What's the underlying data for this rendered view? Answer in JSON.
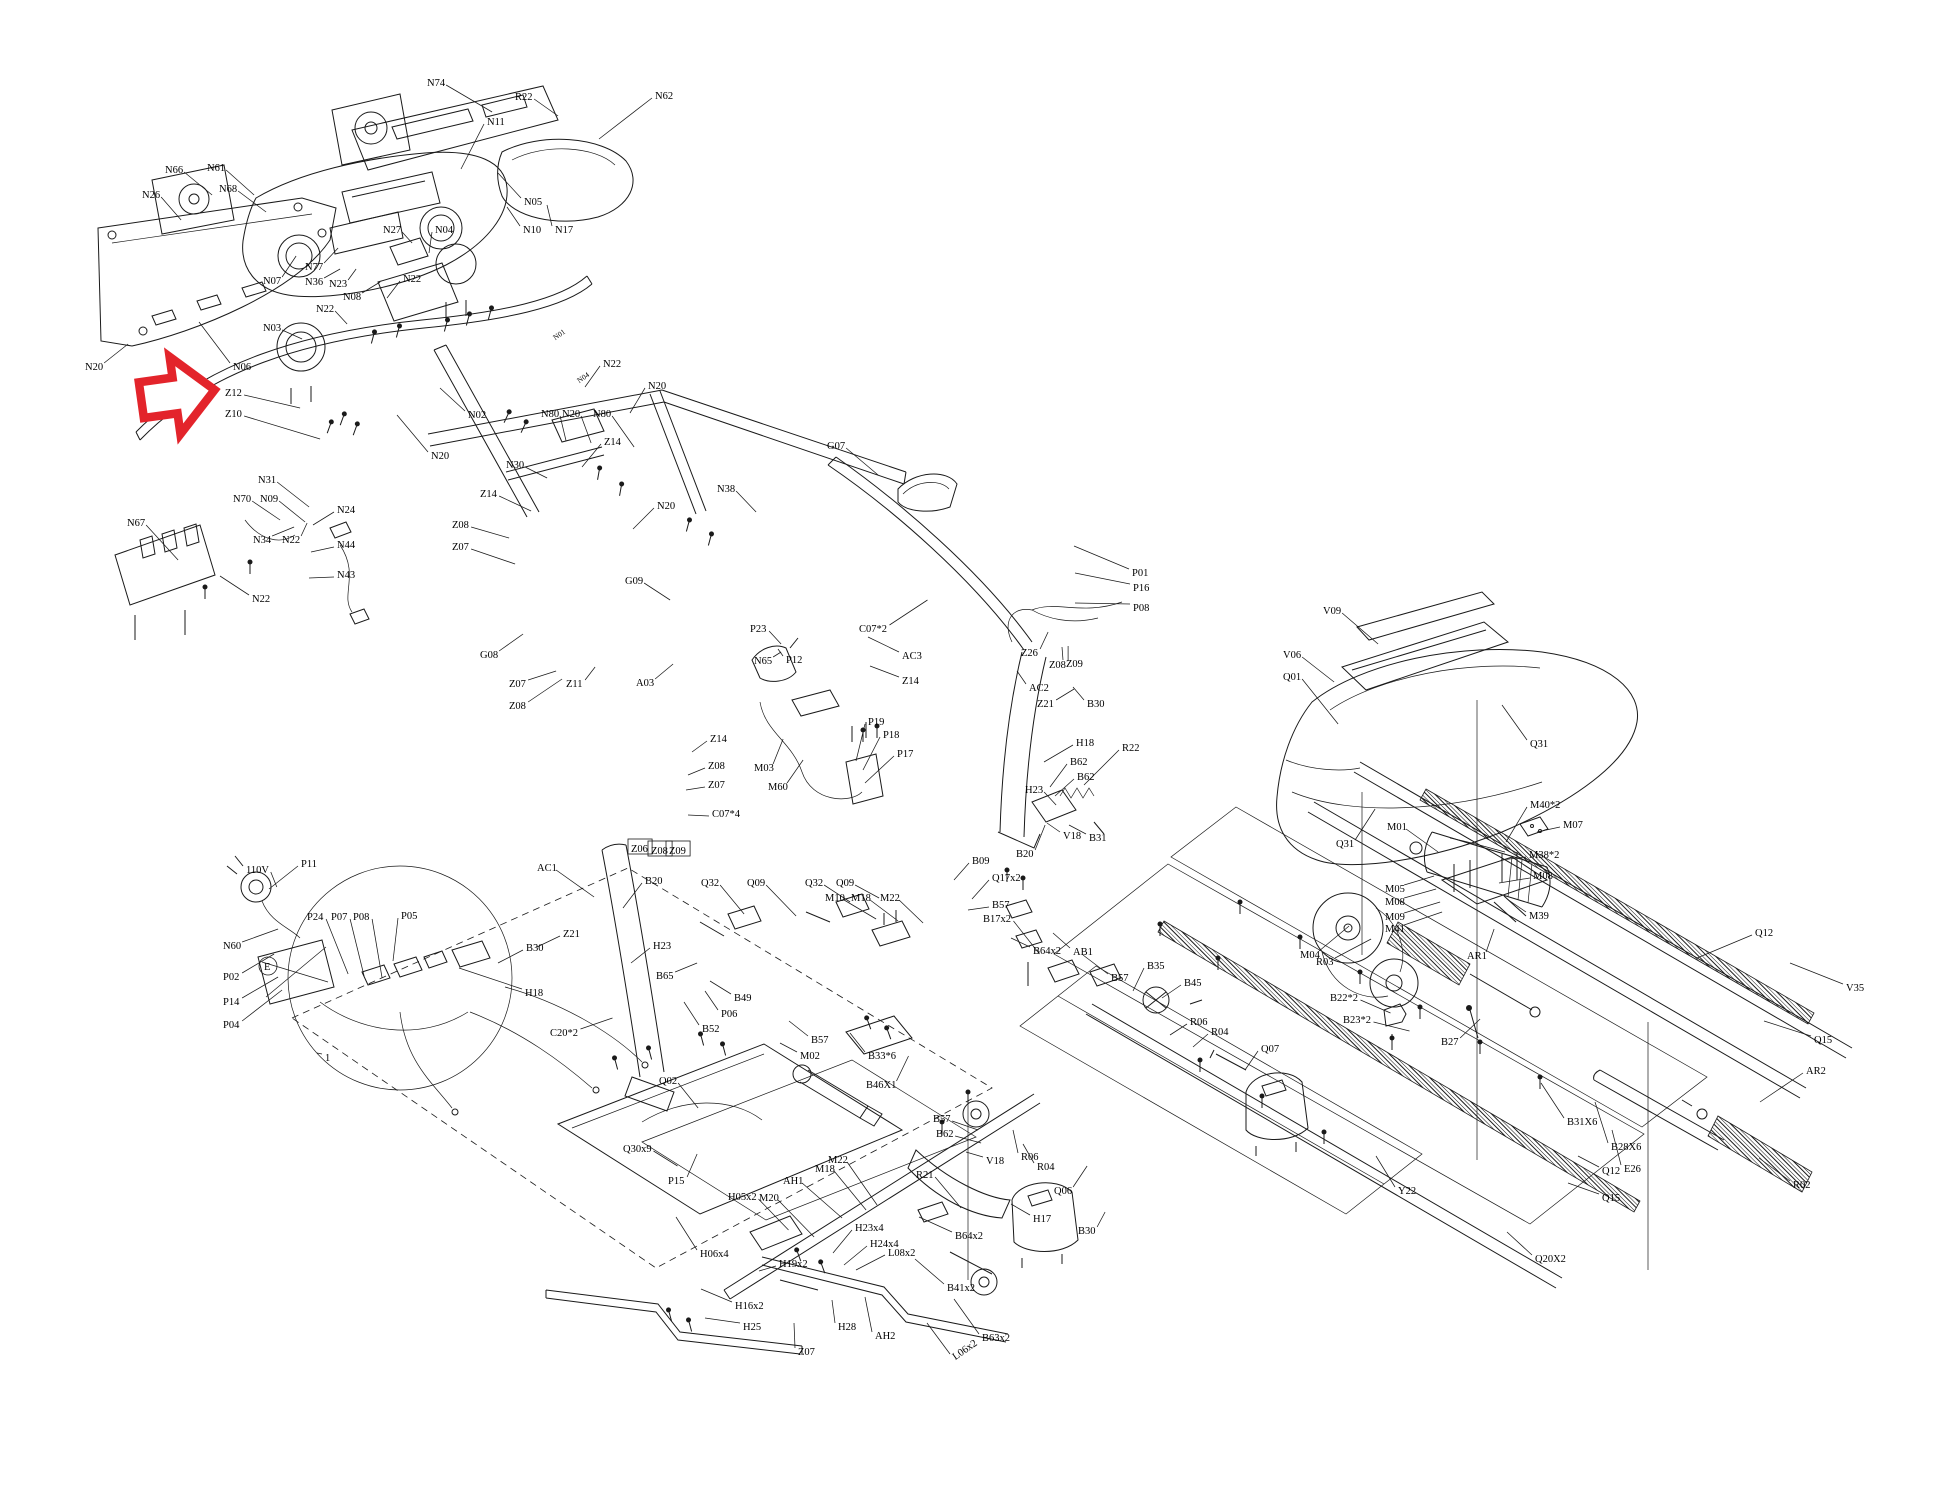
{
  "diagram": {
    "type": "exploded-parts-diagram",
    "subject": "treadmill assembly",
    "background": "#ffffff",
    "line_color": "#1a1a1a"
  },
  "arrow": {
    "color": "#e3242b",
    "points": "141,377 175,377 175,356 215,395 175,434 175,413 141,413",
    "rotation": -8,
    "cx": 178,
    "cy": 395,
    "target_label": "Z12"
  },
  "labels": [
    [
      "N74",
      427,
      82,
      48,
      30,
      null
    ],
    [
      "R22",
      515,
      96,
      26,
      20,
      null
    ],
    [
      "N11",
      487,
      121,
      -26,
      48,
      null
    ],
    [
      "N62",
      655,
      95,
      -56,
      44,
      null
    ],
    [
      "N05",
      524,
      201,
      -26,
      -28,
      null
    ],
    [
      "N10",
      523,
      229,
      -16,
      -22,
      null
    ],
    [
      "N17",
      555,
      229,
      -8,
      -24,
      null
    ],
    [
      "N66",
      165,
      169,
      30,
      26,
      null
    ],
    [
      "N61",
      207,
      167,
      30,
      28,
      null
    ],
    [
      "N26",
      142,
      194,
      22,
      26,
      null
    ],
    [
      "N68",
      219,
      188,
      30,
      24,
      null
    ],
    [
      "N27",
      383,
      229,
      12,
      14,
      null
    ],
    [
      "N04",
      435,
      229,
      -6,
      24,
      null
    ],
    [
      "N07",
      263,
      280,
      16,
      -24,
      null
    ],
    [
      "N77",
      305,
      266,
      16,
      -18,
      null
    ],
    [
      "N36",
      305,
      281,
      18,
      -12,
      null
    ],
    [
      "N23",
      329,
      283,
      10,
      -14,
      null
    ],
    [
      "N08",
      343,
      296,
      20,
      -14,
      null
    ],
    [
      "N22",
      403,
      278,
      -16,
      20,
      null
    ],
    [
      "N22",
      316,
      308,
      14,
      16,
      null
    ],
    [
      "N03",
      263,
      327,
      22,
      12,
      null
    ],
    [
      "N06",
      233,
      366,
      -34,
      -44,
      null
    ],
    [
      "N20",
      85,
      366,
      26,
      -22,
      null
    ],
    [
      "Z12",
      225,
      392,
      58,
      16,
      null
    ],
    [
      "Z10",
      225,
      413,
      78,
      26,
      null
    ],
    [
      "N01",
      553,
      337,
      null,
      null,
      "t"
    ],
    [
      "N04",
      577,
      380,
      null,
      null,
      "t"
    ],
    [
      "N22",
      603,
      363,
      -18,
      24,
      null
    ],
    [
      "N02",
      468,
      414,
      -28,
      -26,
      null
    ],
    [
      "N20",
      431,
      455,
      -34,
      -40,
      null
    ],
    [
      "N20",
      648,
      385,
      -18,
      28,
      null
    ],
    [
      "N80",
      541,
      413,
      8,
      28,
      null
    ],
    [
      "N20",
      562,
      413,
      12,
      30,
      null
    ],
    [
      "N80",
      593,
      413,
      24,
      34,
      null
    ],
    [
      "Z14",
      604,
      441,
      -22,
      26,
      null
    ],
    [
      "N30",
      506,
      464,
      24,
      14,
      null
    ],
    [
      "Z14",
      480,
      493,
      34,
      18,
      null
    ],
    [
      "Z08",
      452,
      524,
      40,
      14,
      null
    ],
    [
      "Z07",
      452,
      546,
      46,
      18,
      null
    ],
    [
      "N20",
      657,
      505,
      -24,
      24,
      null
    ],
    [
      "N31",
      258,
      479,
      34,
      28,
      null
    ],
    [
      "N70",
      233,
      498,
      30,
      22,
      null
    ],
    [
      "N09",
      260,
      498,
      28,
      24,
      null
    ],
    [
      "N67",
      127,
      522,
      34,
      38,
      null
    ],
    [
      "N34",
      253,
      539,
      24,
      -12,
      null
    ],
    [
      "N22",
      282,
      539,
      8,
      -16,
      null
    ],
    [
      "N24",
      337,
      509,
      -24,
      16,
      null
    ],
    [
      "N44",
      337,
      544,
      -26,
      8,
      null
    ],
    [
      "N43",
      337,
      574,
      -28,
      4,
      null
    ],
    [
      "N22",
      252,
      598,
      -32,
      -22,
      null
    ],
    [
      "G08",
      480,
      654,
      26,
      -20,
      null
    ],
    [
      "Z07",
      509,
      683,
      30,
      -12,
      null
    ],
    [
      "Z11",
      566,
      683,
      12,
      -16,
      null
    ],
    [
      "A03",
      636,
      682,
      20,
      -18,
      null
    ],
    [
      "Z08",
      509,
      705,
      36,
      -26,
      null
    ],
    [
      "G09",
      625,
      580,
      28,
      20,
      null
    ],
    [
      "N38",
      717,
      488,
      22,
      24,
      null
    ],
    [
      "G07",
      827,
      445,
      34,
      30,
      null
    ],
    [
      "C07*2",
      859,
      628,
      40,
      -28,
      null
    ],
    [
      "AC3",
      902,
      655,
      -34,
      -18,
      null
    ],
    [
      "Z14",
      902,
      680,
      -32,
      -14,
      null
    ],
    [
      "P01",
      1132,
      572,
      -58,
      -26,
      null
    ],
    [
      "P16",
      1133,
      587,
      -58,
      -14,
      null
    ],
    [
      "P08",
      1133,
      607,
      -58,
      -4,
      null
    ],
    [
      "Z26",
      1021,
      652,
      10,
      -20,
      null
    ],
    [
      "Z08",
      1049,
      664,
      2,
      -18,
      null
    ],
    [
      "Z09",
      1066,
      663,
      -4,
      -16,
      null
    ],
    [
      "AC2",
      1029,
      687,
      -12,
      -16,
      null
    ],
    [
      "Z21",
      1037,
      703,
      20,
      -14,
      null
    ],
    [
      "B30",
      1087,
      703,
      -14,
      -16,
      null
    ],
    [
      "P19",
      868,
      721,
      -12,
      40,
      null
    ],
    [
      "P18",
      883,
      734,
      -20,
      36,
      null
    ],
    [
      "P17",
      897,
      753,
      -32,
      30,
      null
    ],
    [
      "P23",
      750,
      628,
      14,
      16,
      null
    ],
    [
      "N65",
      754,
      660,
      10,
      -8,
      null
    ],
    [
      "P12",
      786,
      659,
      -8,
      -10,
      null
    ],
    [
      "M03",
      754,
      767,
      12,
      -28,
      null
    ],
    [
      "M60",
      768,
      786,
      18,
      -26,
      null
    ],
    [
      "Z14",
      710,
      738,
      -18,
      14,
      null
    ],
    [
      "Z08",
      708,
      765,
      -20,
      10,
      null
    ],
    [
      "Z07",
      708,
      784,
      -22,
      6,
      null
    ],
    [
      "C07*4",
      712,
      813,
      -24,
      2,
      null
    ],
    [
      "Z06",
      631,
      848,
      null,
      null,
      "b"
    ],
    [
      "Z08",
      651,
      850,
      null,
      null,
      "b"
    ],
    [
      "Z09",
      669,
      850,
      null,
      null,
      "b"
    ],
    [
      "AC1",
      537,
      867,
      40,
      30,
      null
    ],
    [
      "B20",
      645,
      880,
      -22,
      28,
      null
    ],
    [
      "Z21",
      563,
      933,
      -26,
      14,
      null
    ],
    [
      "B30",
      526,
      947,
      -28,
      16,
      null
    ],
    [
      "H23",
      653,
      945,
      -22,
      18,
      null
    ],
    [
      "B65",
      656,
      975,
      24,
      -12,
      null
    ],
    [
      "H18",
      525,
      992,
      -66,
      -24,
      null
    ],
    [
      "C20*2",
      550,
      1032,
      34,
      -14,
      null
    ],
    [
      "B52",
      702,
      1028,
      -18,
      -26,
      null
    ],
    [
      "P06",
      721,
      1013,
      -16,
      -22,
      null
    ],
    [
      "B49",
      734,
      997,
      -24,
      -16,
      null
    ],
    [
      "Q02",
      659,
      1080,
      22,
      28,
      null
    ],
    [
      "M02",
      800,
      1055,
      -20,
      -12,
      null
    ],
    [
      "B57",
      811,
      1039,
      -22,
      -18,
      null
    ],
    [
      "B33*6",
      868,
      1055,
      -18,
      -22,
      null
    ],
    [
      "B46X1",
      866,
      1084,
      14,
      -28,
      null
    ],
    [
      "Q32",
      701,
      882,
      26,
      32,
      null
    ],
    [
      "Q09",
      747,
      882,
      32,
      34,
      null
    ],
    [
      "Q32",
      805,
      882,
      28,
      20,
      null
    ],
    [
      "Q09",
      836,
      882,
      26,
      16,
      null
    ],
    [
      "M10",
      825,
      897,
      34,
      22,
      null
    ],
    [
      "M18",
      851,
      897,
      30,
      24,
      null
    ],
    [
      "M22",
      880,
      897,
      26,
      26,
      null
    ],
    [
      "B09",
      972,
      860,
      -18,
      20,
      null
    ],
    [
      "Q17x2",
      992,
      877,
      -20,
      22,
      null
    ],
    [
      "B57",
      992,
      904,
      -24,
      6,
      null
    ],
    [
      "B17x2",
      983,
      918,
      28,
      36,
      null
    ],
    [
      "B64x2",
      1033,
      950,
      -22,
      -12,
      null
    ],
    [
      "AB1",
      1073,
      951,
      -20,
      -18,
      null
    ],
    [
      "B57",
      1111,
      977,
      -28,
      -22,
      null
    ],
    [
      "B35",
      1147,
      965,
      -14,
      26,
      null
    ],
    [
      "B45",
      1184,
      982,
      -22,
      16,
      null
    ],
    [
      "R06",
      1190,
      1021,
      -20,
      14,
      null
    ],
    [
      "R04",
      1211,
      1031,
      -18,
      16,
      null
    ],
    [
      "Q07",
      1261,
      1048,
      -16,
      22,
      null
    ],
    [
      "R06",
      1021,
      1156,
      -8,
      -26,
      null
    ],
    [
      "R04",
      1037,
      1166,
      -14,
      -22,
      null
    ],
    [
      "Q06",
      1054,
      1190,
      16,
      -24,
      null
    ],
    [
      "B30",
      1078,
      1230,
      10,
      -18,
      null
    ],
    [
      "V18",
      986,
      1160,
      -20,
      -8,
      null
    ],
    [
      "H18",
      1076,
      742,
      -32,
      20,
      null
    ],
    [
      "R22",
      1122,
      747,
      -38,
      38,
      null
    ],
    [
      "B62",
      1070,
      761,
      -20,
      26,
      null
    ],
    [
      "B62",
      1077,
      776,
      -22,
      20,
      null
    ],
    [
      "H23",
      1025,
      789,
      14,
      16,
      null
    ],
    [
      "V18",
      1063,
      835,
      -16,
      -12,
      null
    ],
    [
      "B31",
      1089,
      837,
      -20,
      -12,
      null
    ],
    [
      "B20",
      1016,
      853,
      12,
      -28,
      null
    ],
    [
      "Q30x9",
      623,
      1148,
      26,
      18,
      null
    ],
    [
      "P15",
      668,
      1180,
      12,
      -26,
      null
    ],
    [
      "H05x2",
      728,
      1196,
      32,
      34,
      null
    ],
    [
      "M20",
      759,
      1197,
      38,
      40,
      null
    ],
    [
      "AH1",
      783,
      1180,
      42,
      38,
      null
    ],
    [
      "M18",
      815,
      1168,
      34,
      42,
      null
    ],
    [
      "M22",
      828,
      1159,
      32,
      46,
      null
    ],
    [
      "R21",
      916,
      1174,
      28,
      34,
      null
    ],
    [
      "B57",
      933,
      1118,
      28,
      12,
      null
    ],
    [
      "B62",
      936,
      1133,
      28,
      10,
      null
    ],
    [
      "H17",
      1033,
      1218,
      -22,
      -14,
      null
    ],
    [
      "H23x4",
      855,
      1227,
      -22,
      26,
      null
    ],
    [
      "H24x4",
      870,
      1243,
      -26,
      22,
      null
    ],
    [
      "L08x2",
      888,
      1252,
      -32,
      18,
      null
    ],
    [
      "H19x2",
      779,
      1263,
      -20,
      8,
      null
    ],
    [
      "H06x4",
      700,
      1253,
      -24,
      -36,
      null
    ],
    [
      "H16x2",
      735,
      1305,
      -34,
      -16,
      null
    ],
    [
      "H25",
      743,
      1326,
      -38,
      -8,
      null
    ],
    [
      "Z07",
      798,
      1351,
      -4,
      -28,
      null
    ],
    [
      "H28",
      838,
      1326,
      -6,
      -26,
      null
    ],
    [
      "AH2",
      875,
      1335,
      -10,
      -38,
      null
    ],
    [
      "B41x2",
      947,
      1287,
      -32,
      -28,
      null
    ],
    [
      "B64x2",
      955,
      1235,
      -36,
      -18,
      null
    ],
    [
      "L06x2",
      953,
      1357,
      -26,
      -34,
      "r"
    ],
    [
      "B63x2",
      982,
      1337,
      -28,
      -38,
      null
    ],
    [
      "V09",
      1323,
      610,
      38,
      34,
      null
    ],
    [
      "V06",
      1283,
      654,
      34,
      28,
      null
    ],
    [
      "Q01",
      1283,
      676,
      38,
      48,
      null
    ],
    [
      "Q31",
      1530,
      743,
      -28,
      -38,
      null
    ],
    [
      "Q31",
      1336,
      843,
      22,
      -34,
      null
    ],
    [
      "M01",
      1387,
      826,
      34,
      26,
      null
    ],
    [
      "M40*2",
      1530,
      804,
      -24,
      38,
      null
    ],
    [
      "M07",
      1563,
      824,
      -26,
      8,
      null
    ],
    [
      "M38*2",
      1529,
      854,
      -28,
      6,
      null
    ],
    [
      "M08",
      1533,
      875,
      -34,
      8,
      null
    ],
    [
      "M05",
      1385,
      888,
      32,
      -12,
      null
    ],
    [
      "M08",
      1385,
      901,
      34,
      -12,
      null
    ],
    [
      "M09",
      1385,
      916,
      38,
      -14,
      null
    ],
    [
      "M41",
      1385,
      928,
      40,
      -16,
      null
    ],
    [
      "M39",
      1529,
      915,
      -22,
      -16,
      null
    ],
    [
      "M04",
      1300,
      954,
      32,
      -28,
      null
    ],
    [
      "R03",
      1316,
      961,
      38,
      -22,
      null
    ],
    [
      "AR1",
      1467,
      955,
      10,
      -26,
      null
    ],
    [
      "B22*2",
      1330,
      997,
      32,
      16,
      null
    ],
    [
      "B23*2",
      1343,
      1019,
      38,
      12,
      null
    ],
    [
      "B27",
      1441,
      1041,
      22,
      -22,
      null
    ],
    [
      "B31X6",
      1567,
      1121,
      -26,
      -38,
      null
    ],
    [
      "B28X6",
      1611,
      1146,
      -16,
      -44,
      null
    ],
    [
      "Q12",
      1602,
      1170,
      -24,
      -14,
      null
    ],
    [
      "E26",
      1624,
      1168,
      -12,
      -38,
      null
    ],
    [
      "Q15",
      1602,
      1197,
      -34,
      -14,
      null
    ],
    [
      "Q20X2",
      1535,
      1258,
      -28,
      -26,
      null
    ],
    [
      "Y22",
      1398,
      1190,
      -22,
      -34,
      null
    ],
    [
      "Q12",
      1755,
      932,
      -58,
      26,
      null
    ],
    [
      "V35",
      1846,
      987,
      -56,
      -24,
      null
    ],
    [
      "Q15",
      1814,
      1039,
      -50,
      -18,
      null
    ],
    [
      "AR2",
      1806,
      1070,
      -46,
      32,
      null
    ],
    [
      "R02",
      1793,
      1184,
      -34,
      -26,
      null
    ],
    [
      "110V",
      246,
      869,
      8,
      18,
      null
    ],
    [
      "P11",
      301,
      863,
      -32,
      26,
      null
    ],
    [
      "P24",
      307,
      916,
      24,
      58,
      null
    ],
    [
      "P07",
      331,
      916,
      16,
      60,
      null
    ],
    [
      "P08",
      353,
      916,
      12,
      62,
      null
    ],
    [
      "P05",
      401,
      915,
      -8,
      46,
      null
    ],
    [
      "N60",
      223,
      945,
      38,
      -16,
      null
    ],
    [
      "P02",
      223,
      976,
      34,
      -22,
      null
    ],
    [
      "P14",
      223,
      1001,
      38,
      -24,
      null
    ],
    [
      "P04",
      223,
      1024,
      42,
      -34,
      null
    ],
    [
      "E",
      264,
      966,
      null,
      null,
      "c"
    ],
    [
      "1",
      325,
      1057,
      -8,
      -4,
      null
    ]
  ]
}
